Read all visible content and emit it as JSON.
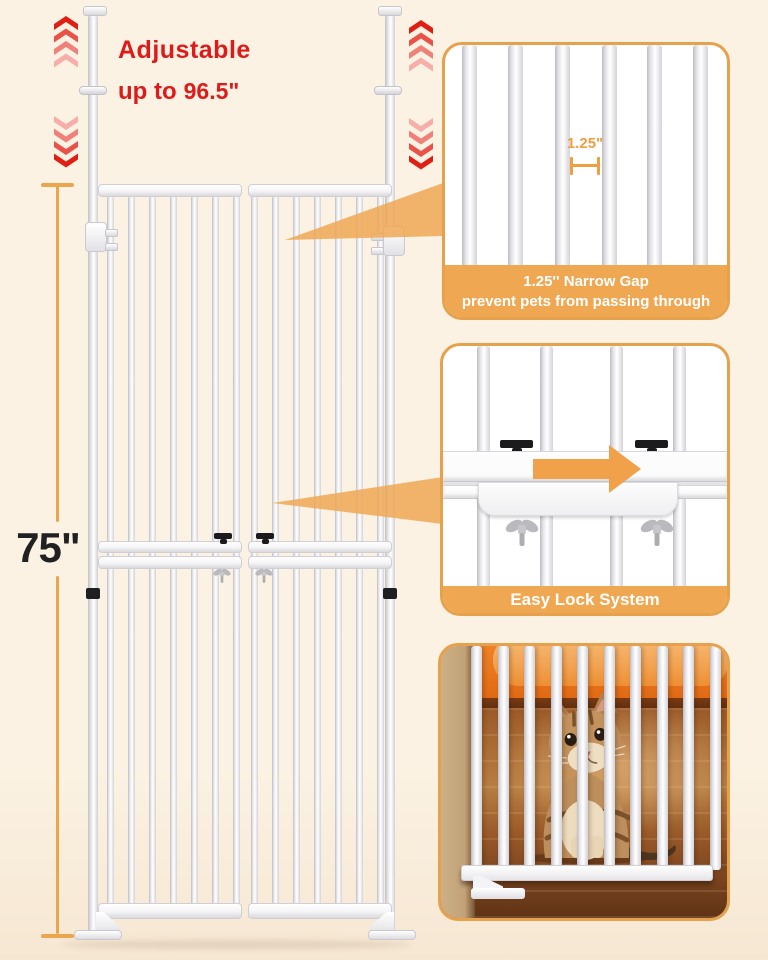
{
  "colors": {
    "background": "#FBF2E3",
    "background_bottom": "#F6E7D2",
    "accent_orange": "#EFA64F",
    "panel_border": "#E6A14C",
    "caption_band": "#F0A751",
    "caption_text": "#FFFFFF",
    "headline_red": "#DC1B1B",
    "measure_line": "#E9A64D",
    "measure_text": "#212121",
    "arrow_orange": "#F0A14A",
    "leader_orange": "#EFA855",
    "marker_orange": "#EE9F41",
    "chevron_up": [
      "#E01F14",
      "#E85248",
      "#F08179",
      "#F6AEA8"
    ],
    "chevron_down": [
      "#F6AEA8",
      "#F08179",
      "#E85248",
      "#E01F14"
    ]
  },
  "headline": {
    "line1": "Adjustable",
    "line2_prefix": "up to",
    "line2_value": "96.5\""
  },
  "measurement": {
    "height_label": "75\""
  },
  "panels": {
    "narrow_gap": {
      "gap_label": "1.25\"",
      "caption_line1": "1.25'' Narrow Gap",
      "caption_line2": "prevent pets from passing through"
    },
    "easy_lock": {
      "caption": "Easy Lock System"
    }
  },
  "icons": {
    "stretch_up": "chevron-up-stack",
    "stretch_down": "chevron-down-stack",
    "slide_direction": "arrow-right",
    "gap_measure": "i-beam-marker"
  }
}
